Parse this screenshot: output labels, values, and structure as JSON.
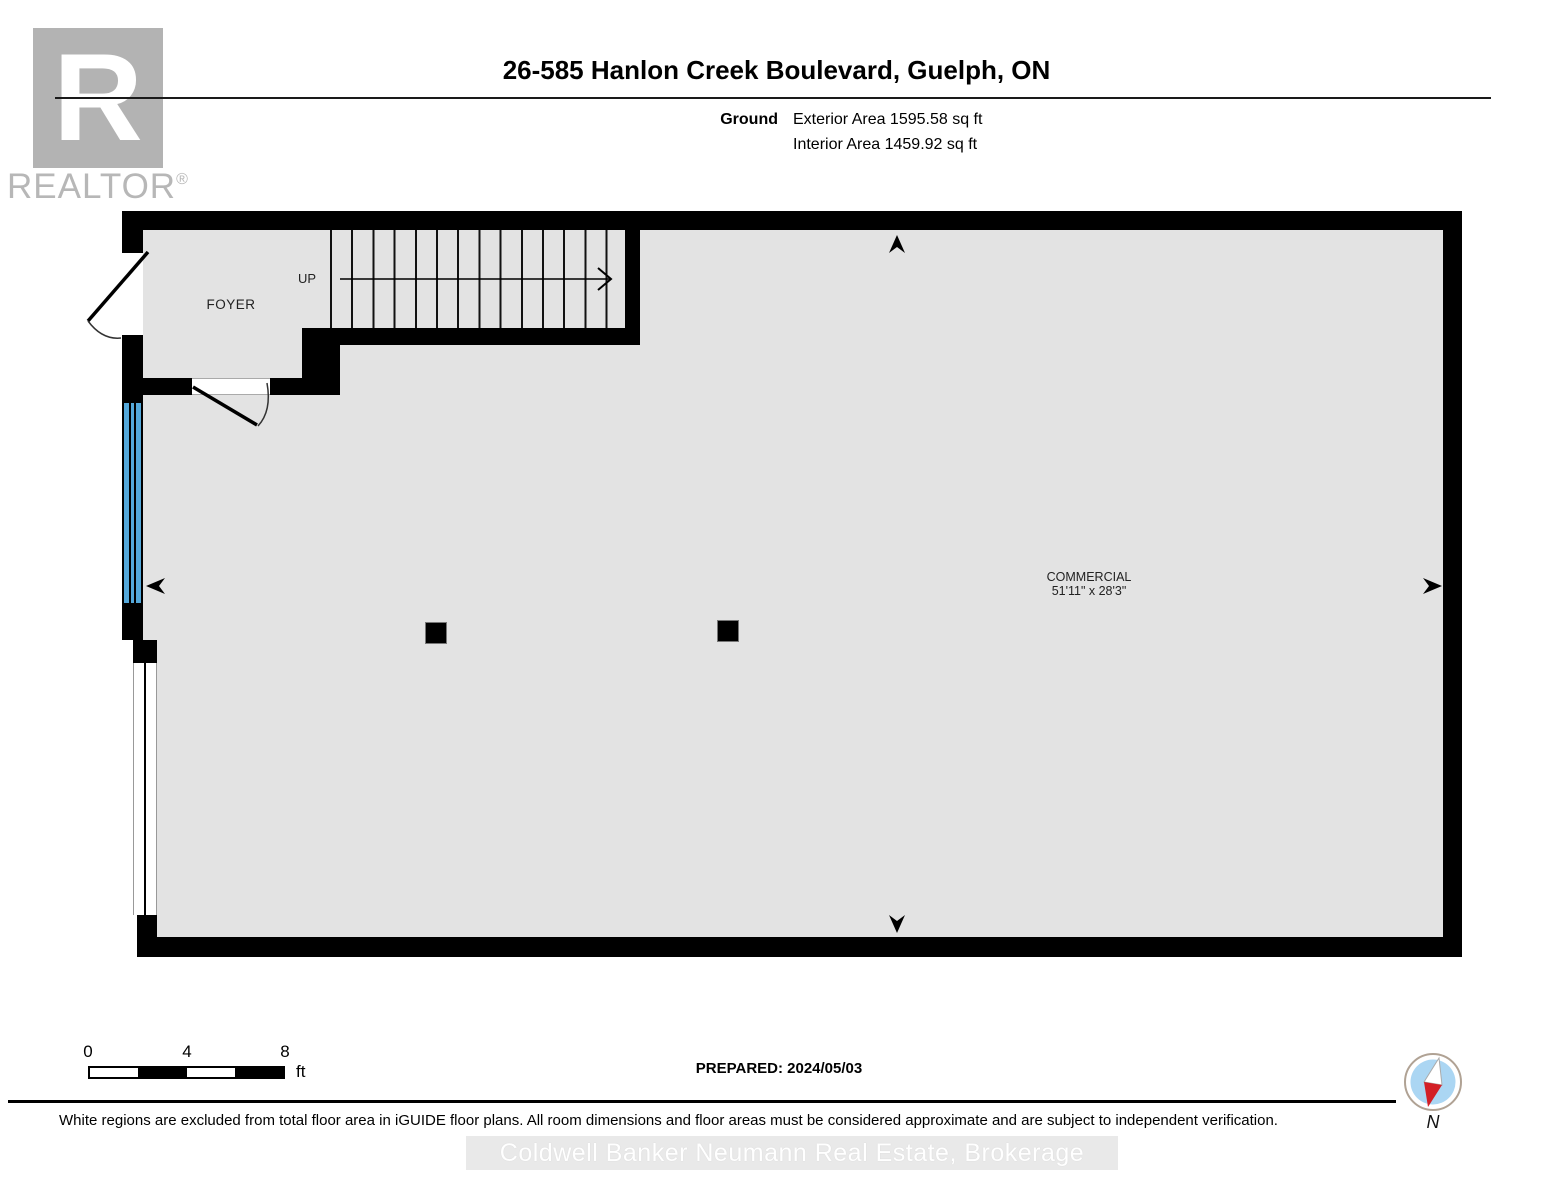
{
  "branding": {
    "logo_letter": "R",
    "logo_wordmark": "REALTOR",
    "logo_reg": "®"
  },
  "header": {
    "title": "26-585 Hanlon Creek Boulevard, Guelph, ON",
    "floor_label": "Ground",
    "exterior_area": "Exterior Area 1595.58 sq ft",
    "interior_area": "Interior Area 1459.92 sq ft"
  },
  "floorplan": {
    "foyer_label": "FOYER",
    "stairs_label": "UP",
    "commercial_label": "COMMERCIAL",
    "commercial_dimensions": "51'11\" x 28'3\"",
    "colors": {
      "wall": "#000000",
      "floor": "#e3e3e3",
      "window": "#54a8da",
      "compass_blue": "#abd6f3",
      "compass_red": "#d31f26"
    }
  },
  "footer": {
    "scale_ticks": [
      "0",
      "4",
      "8"
    ],
    "scale_unit": "ft",
    "prepared": "PREPARED: 2024/05/03",
    "compass_label": "N",
    "disclaimer": "White regions are excluded from total floor area in iGUIDE floor plans. All room dimensions and floor areas must be considered approximate and are subject to independent verification.",
    "watermark": "Coldwell Banker Neumann Real Estate, Brokerage"
  }
}
